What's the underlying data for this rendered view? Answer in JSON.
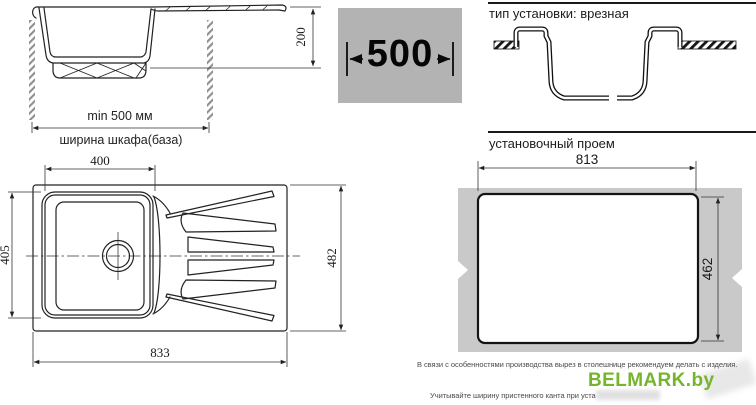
{
  "side_view": {
    "depth": "200",
    "min_width": "min 500 мм",
    "cabinet_width": "ширина шкафа(база)"
  },
  "cabinet_width_box": {
    "value": "500"
  },
  "install_type": {
    "title": "тип установки: врезная"
  },
  "mounting_opening": {
    "title": "установочный проем",
    "width": "813",
    "height": "462"
  },
  "top_view": {
    "bowl_width": "400",
    "bowl_length": "405",
    "overall_width": "833",
    "overall_length": "482"
  },
  "footer": {
    "note_production": "В связи с особенностями производства вырез в столешнице рекомендуем делать с изделия.",
    "note_edging": "Учитывайте ширину пристенного канта при уста",
    "brand": "BELMARK.by"
  },
  "colors": {
    "accent_green": "#74b52b",
    "width_box_gray": "#b3b3b3",
    "countertop_gray": "#c9c9c9"
  }
}
